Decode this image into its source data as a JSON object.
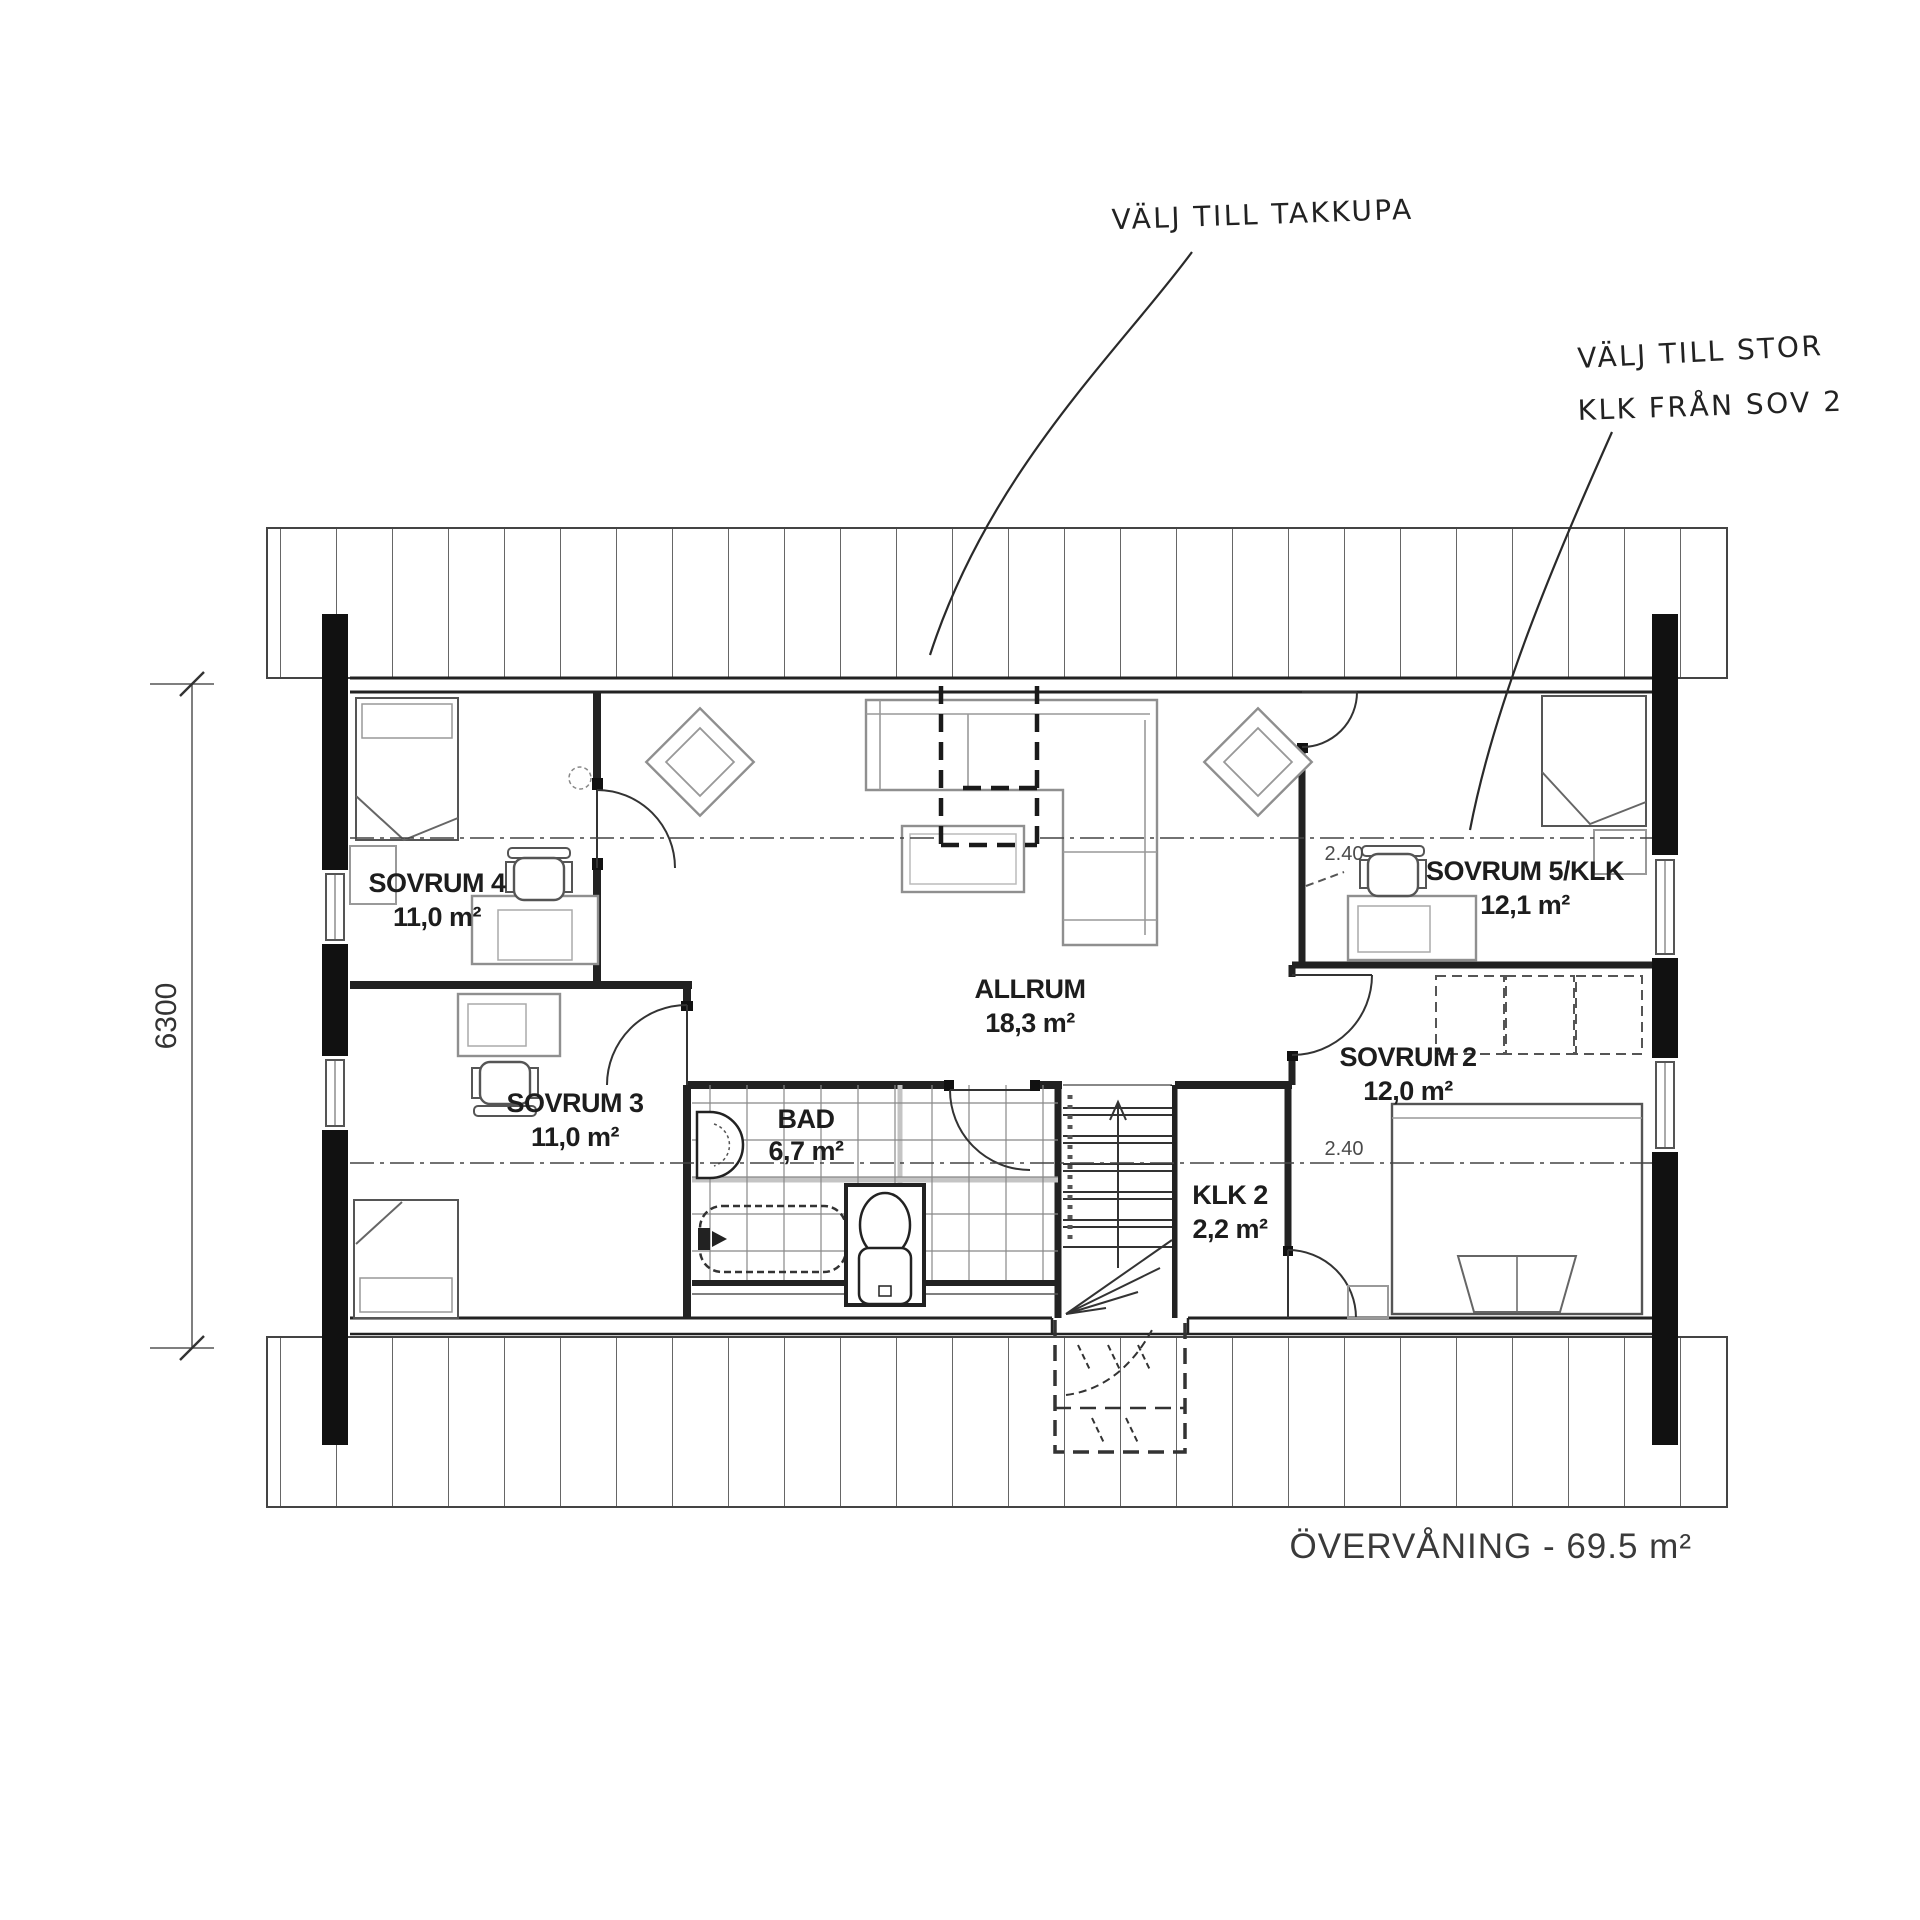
{
  "meta": {
    "title": "ÖVERVÅNING - 69.5 m²"
  },
  "annotations": {
    "takkupa": "VÄLJ TILL TAKKUPA",
    "klk_line1": "VÄLJ TILL STOR",
    "klk_line2": "KLK FRÅN SOV 2"
  },
  "dimensions": {
    "left_height": "6300"
  },
  "ceiling": {
    "upper": "2.40",
    "lower": "2.40"
  },
  "rooms": {
    "sovrum4": {
      "name": "SOVRUM 4",
      "area": "11,0 m²"
    },
    "sovrum3": {
      "name": "SOVRUM 3",
      "area": "11,0 m²"
    },
    "allrum": {
      "name": "ALLRUM",
      "area": "18,3 m²"
    },
    "bad": {
      "name": "BAD",
      "area": "6,7 m²"
    },
    "klk2": {
      "name": "KLK 2",
      "area": "2,2 m²"
    },
    "sovrum2": {
      "name": "SOVRUM 2",
      "area": "12,0 m²"
    },
    "sovrum5": {
      "name": "SOVRUM 5/KLK",
      "area": "12,1 m²"
    }
  },
  "colors": {
    "wall": "#111111",
    "ink": "#222222",
    "furniture": "#8f8f8f"
  }
}
